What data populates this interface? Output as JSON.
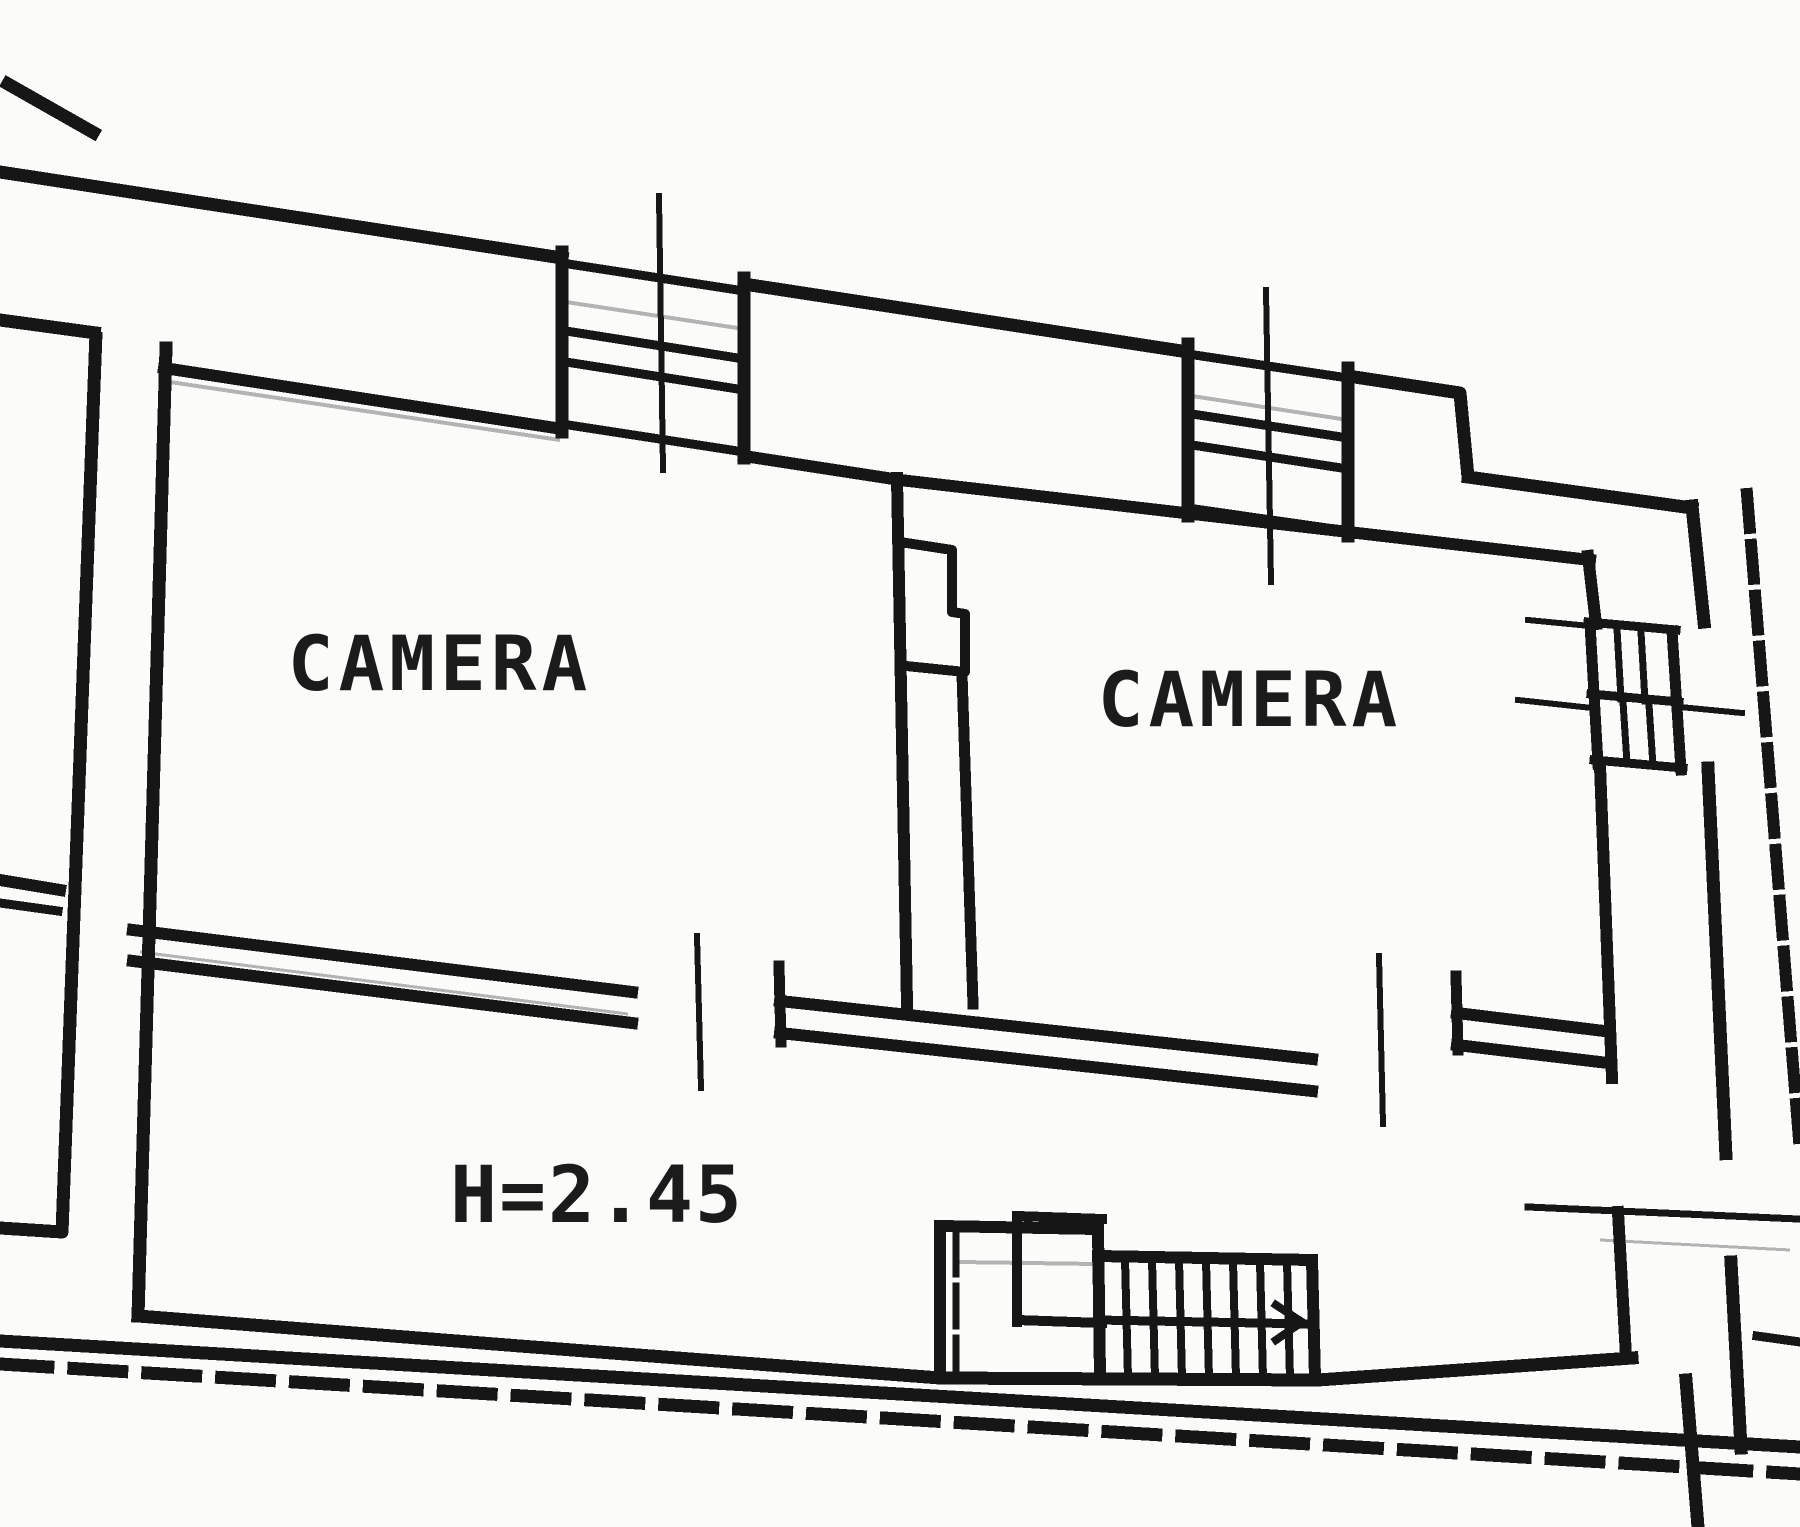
{
  "page": {
    "background": "#fbfbf9",
    "ink": "#161616",
    "ghost_line": "#b3b3b3",
    "description_labels": {
      "drawing_type": "floor-plan"
    }
  },
  "floorplan": {
    "rooms": [
      {
        "id": "camera-left",
        "label": "CAMERA"
      },
      {
        "id": "camera-right",
        "label": "CAMERA"
      }
    ],
    "annotations": [
      {
        "id": "ceiling-height",
        "label": "H=2.45"
      }
    ],
    "symbols": {
      "windows": [
        "window-top-left",
        "window-top-right",
        "window-right-wall"
      ],
      "doors": [
        "door-camera-left",
        "door-camera-right",
        "door-right-wall"
      ],
      "staircase": "staircase-bottom"
    }
  }
}
